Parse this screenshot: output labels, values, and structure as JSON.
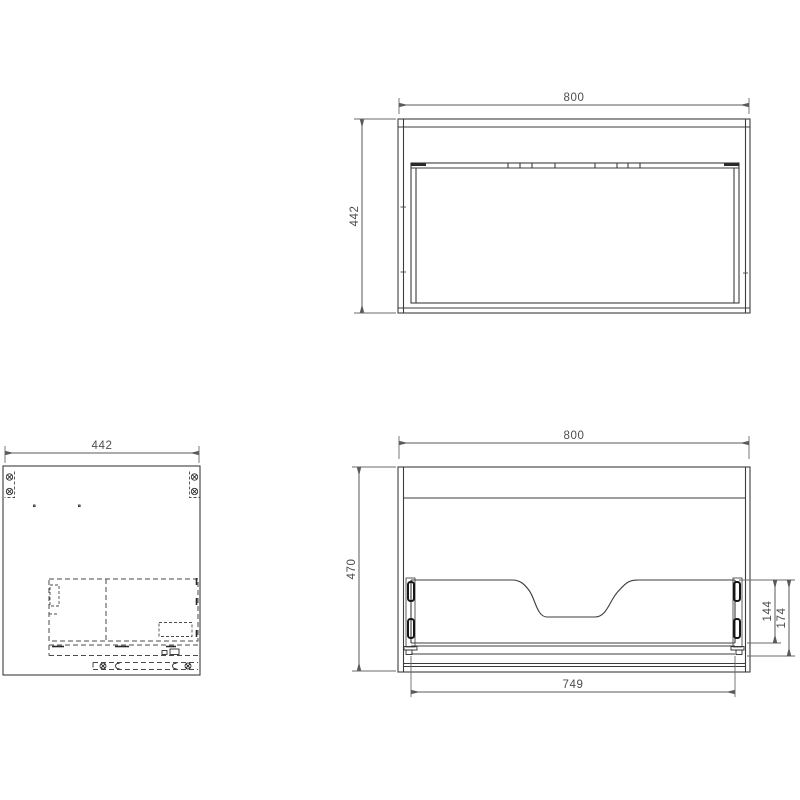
{
  "drawing": {
    "colors": {
      "object_line": "#3c3c3c",
      "dimension_line": "#595959",
      "hidden_line": "#4a4a4a",
      "text": "#4d4d4d",
      "background": "#ffffff"
    },
    "top_view": {
      "width_label": "800",
      "depth_label": "442"
    },
    "side_view": {
      "depth_label": "442"
    },
    "front_view": {
      "width_label": "800",
      "height_label": "470",
      "drawer_width_label": "749",
      "inner_height_a_label": "144",
      "inner_height_b_label": "174"
    }
  }
}
